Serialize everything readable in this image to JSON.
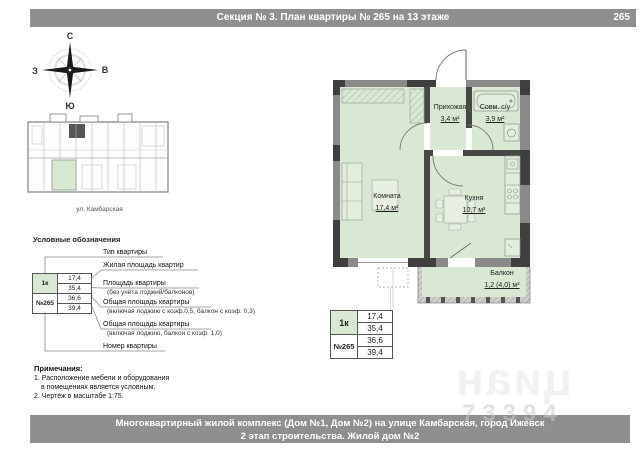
{
  "header": {
    "title": "Секция № 3. План квартиры № 265 на 13 этаже",
    "sheet_number": "265"
  },
  "compass": {
    "north": "С",
    "south": "Ю",
    "west": "З",
    "east": "В"
  },
  "key_plan": {
    "caption": "ул. Камбарская"
  },
  "legend": {
    "title": "Условные обозначения",
    "sample": {
      "type": "1к",
      "number": "№265",
      "values": [
        "17,4",
        "35,4",
        "36,6",
        "39,4"
      ]
    },
    "labels": [
      {
        "line1": "Тип квартиры",
        "line2": ""
      },
      {
        "line1": "Жилая площадь квартир",
        "line2": ""
      },
      {
        "line1": "Площадь квартиры",
        "line2": "(без учёта лоджий/балконов)"
      },
      {
        "line1": "Общая площадь квартиры",
        "line2": "(включая лоджию с коэф.0,5, балкон с коэф. 0,3)"
      },
      {
        "line1": "Общая площадь квартиры",
        "line2": "(включая лоджию, балкон с коэф. 1,0)"
      },
      {
        "line1": "Номер квартиры",
        "line2": ""
      }
    ]
  },
  "notes": {
    "title": "Примечания:",
    "lines": [
      "1. Расположение мебели и оборудования",
      "в помещениях является условным.",
      "2. Чертёж в масштабе 1:75."
    ]
  },
  "floor_plan": {
    "rooms": [
      {
        "name": "Прихожая",
        "area": "3,4 м²"
      },
      {
        "name": "Совм. с/у",
        "area": "3,9 м²"
      },
      {
        "name": "Комната",
        "area": "17,4 м²"
      },
      {
        "name": "Кухня",
        "area": "10,7 м²"
      },
      {
        "name": "Балкон",
        "area": "1,2 (4,0) м²"
      }
    ]
  },
  "info_table": {
    "type": "1к",
    "number": "№265",
    "values": [
      "17,4",
      "35,4",
      "36,6",
      "39,4"
    ]
  },
  "watermark": {
    "logo": "циан",
    "digits": "73394"
  },
  "footer": {
    "line1": "Многоквартирный жилой комплекс (Дом №1, Дом №2) на улице Камбарская, город Ижевск",
    "line2": "2 этап строительства. Жилой дом №2"
  },
  "colors": {
    "accent_green": "#d9e8d3",
    "bar_gray": "#8f8f8f",
    "wall_gray": "#8a8a8a",
    "wall_dark": "#3f3f3f"
  }
}
